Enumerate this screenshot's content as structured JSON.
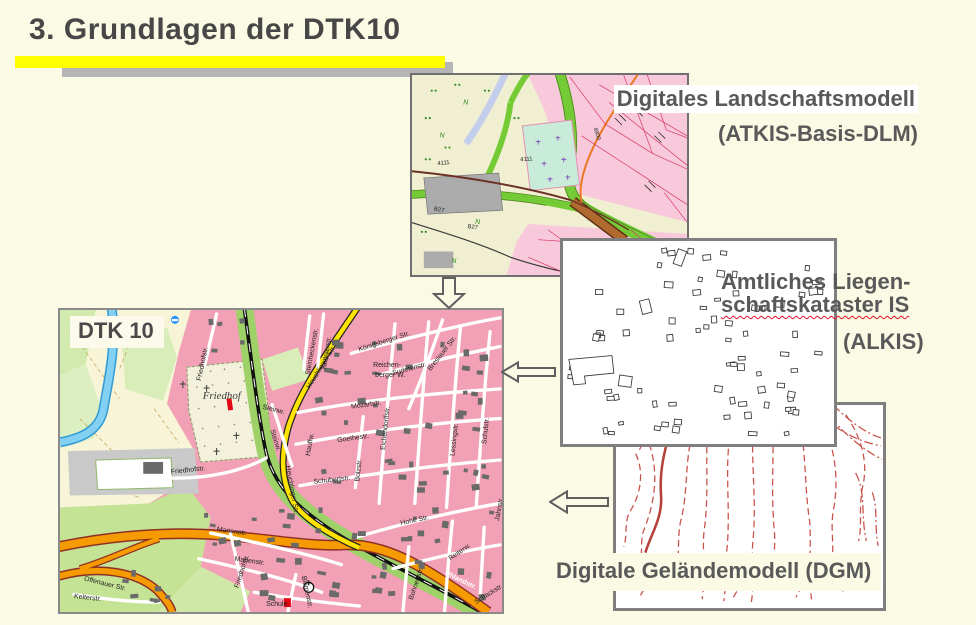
{
  "slide": {
    "title": "3. Grundlagen der DTK10"
  },
  "colors": {
    "background": "#FBFAE5",
    "title_text": "#474747",
    "label_text": "#595959",
    "highlight_bar": "#FFFF00",
    "highlight_shadow": "#B5B5B5",
    "spellcheck_wave": "#E8112D",
    "dtk_urban_pink": "#F2A0B5",
    "dgm_contour_red": "#C9534B"
  },
  "icons": {
    "flow_down": "block-arrow-down",
    "flow_left_alkis": "block-arrow-left",
    "flow_left_dgm": "block-arrow-left"
  },
  "dlm": {
    "line1": "Digitales Landschaftsmodell",
    "line2": "(ATKIS-Basis-DLM)"
  },
  "alkis": {
    "line1": "Amtliches Liegen-",
    "line2": "schaftskataster IS",
    "line3": "(ALKIS)"
  },
  "dgm": {
    "label": "Digitale Geländemodell (DGM)"
  },
  "dtk": {
    "badge": "DTK 10",
    "streets": [
      "Friedhofstr.",
      "Friedhofstr.",
      "Friedhofstr.",
      "Friedhof",
      "Steinw.",
      "Steinw.",
      "Heuchlinger Str.",
      "Heuchlinger Str.",
      "Mozartstr.",
      "Goethestr.",
      "Schubertstr.",
      "Reichen-",
      "berger W.",
      "Königsberger Str.",
      "Sudetenstr.",
      "Breslauer Str.",
      "Eichendorffstr.",
      "Lessingstr.",
      "Schulstr.",
      "Hauffw.",
      "Bolzstr.",
      "Hohe Str.",
      "Marienstr.",
      "Marienstr.",
      "Offenauer Str.",
      "Blumenstr.",
      "Schule",
      "Kelterstr.",
      "Kettelerstr.",
      "Steinheckenstr.",
      "Uhlandstr.",
      "Jahnstr.",
      "Reiterw.",
      "Bohnertstr.",
      "Schackstr."
    ]
  },
  "atkis": {
    "road_labels": [
      "4111",
      "4111",
      "B27",
      "B27",
      "4900"
    ],
    "meadow_symbol": "N"
  }
}
